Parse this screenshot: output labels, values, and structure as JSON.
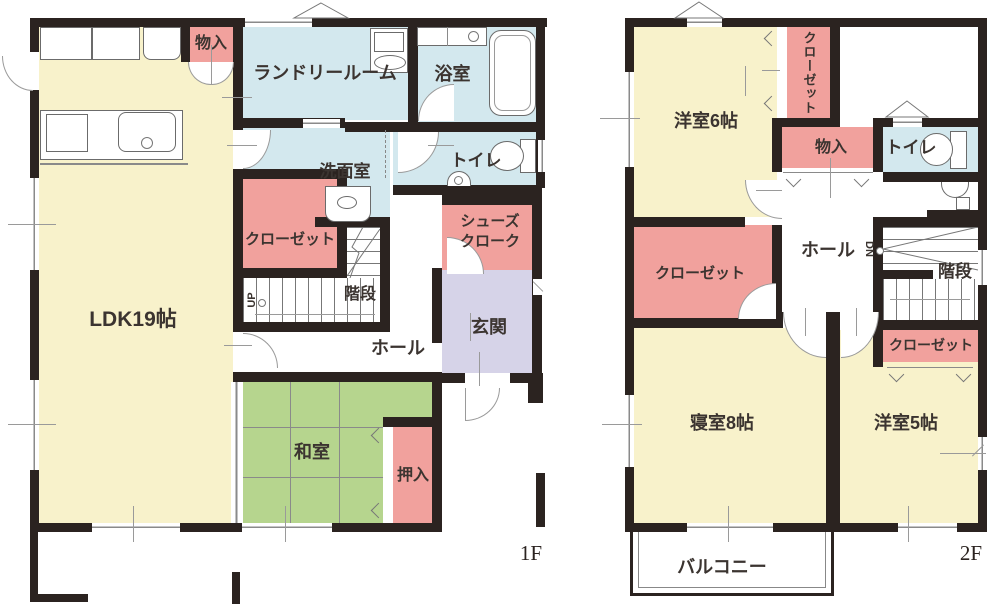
{
  "palette": {
    "wall": "#2b2320",
    "room_yellow": "#f8f2cb",
    "tatami_green": "#b6d58e",
    "storage_pink": "#f1a19d",
    "wet_area_blue": "#d3e8ee",
    "entrance_lavender": "#d6d3e8"
  },
  "f1": {
    "floor_label": "1F",
    "ldk": "LDK19帖",
    "monoire": "物入",
    "laundry": "ランドリールーム",
    "bath": "浴室",
    "senmen": "洗面室",
    "toilet": "トイレ",
    "closet": "クローゼット",
    "shoes_line1": "シューズ",
    "shoes_line2": "クローク",
    "stairs": "階段",
    "up": "UP",
    "hall": "ホール",
    "genkan": "玄関",
    "washitsu": "和室",
    "oshiire": "押入"
  },
  "f2": {
    "floor_label": "2F",
    "yoshitsu6": "洋室6帖",
    "closet_north": "クローゼット",
    "monoire": "物入",
    "toilet": "トイレ",
    "hall": "ホール",
    "dn": "DN",
    "stairs": "階段",
    "closet_west": "クローゼット",
    "closet_small": "クローゼット",
    "bedroom": "寝室8帖",
    "yoshitsu5": "洋室5帖",
    "balcony": "バルコニー"
  }
}
